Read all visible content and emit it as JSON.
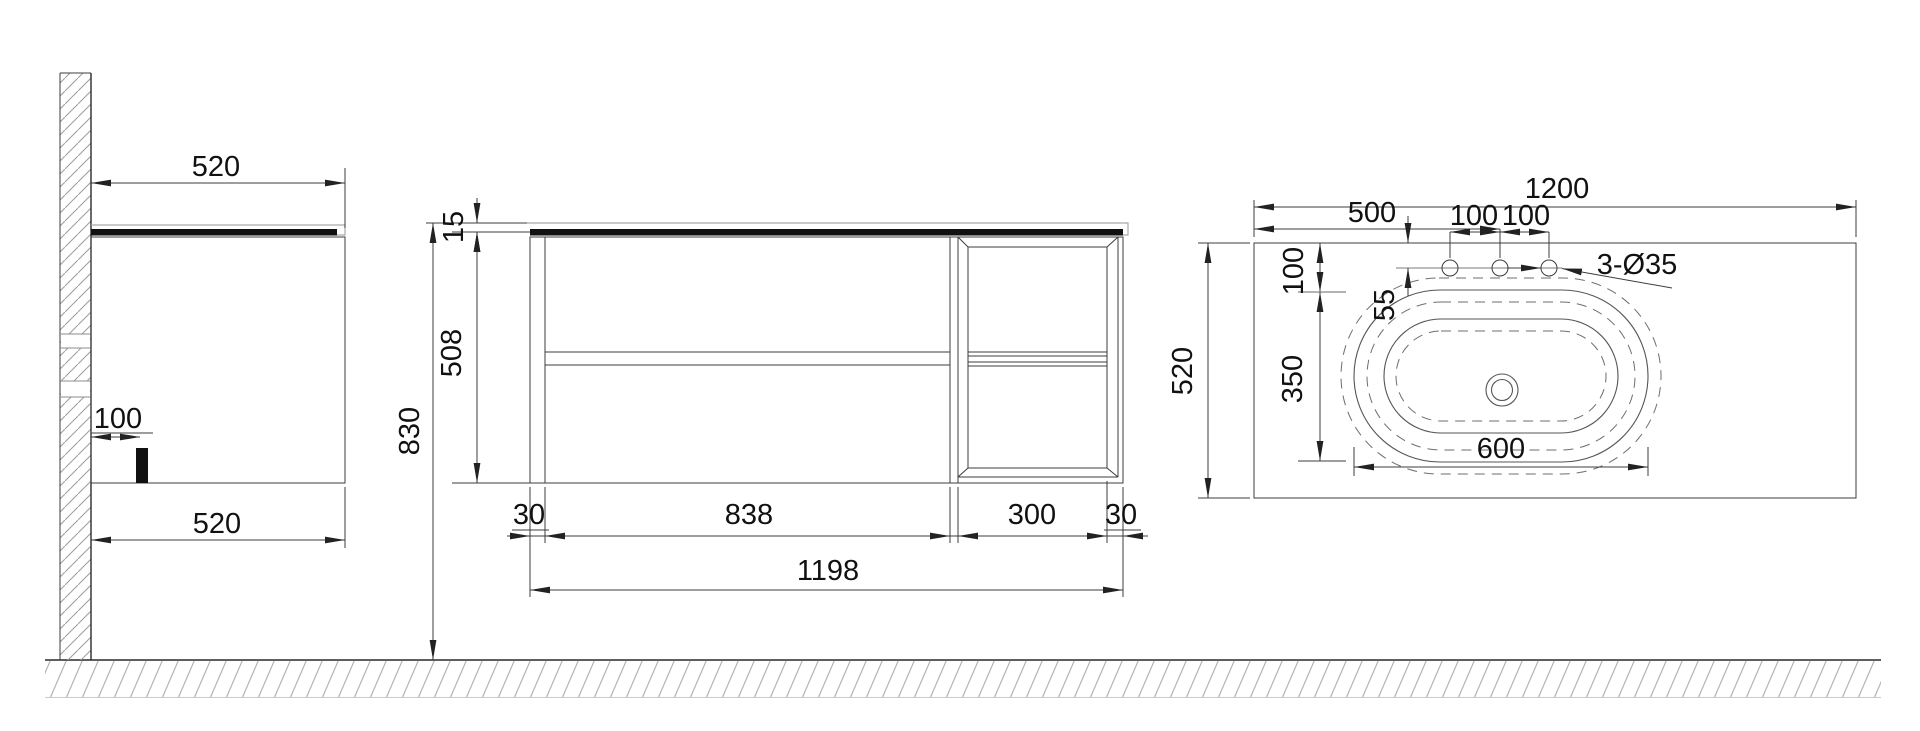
{
  "drawing": {
    "kind": "vanity cabinet technical drawing",
    "colors": {
      "line": "#2a2a2a",
      "hatch": "#9c9c9c",
      "slab": "#111111"
    },
    "views": {
      "side": {
        "dims": {
          "top_width": "520",
          "cleat_offset": "100",
          "bottom_width": "520"
        }
      },
      "front": {
        "dims": {
          "counter_thickness": "15",
          "cabinet_height": "508",
          "overall_height": "830",
          "left_gable": "30",
          "drawer_bay_width": "838",
          "shelf_bay_width": "300",
          "right_gable": "30",
          "cabinet_width": "1198"
        }
      },
      "top": {
        "dims": {
          "counter_width": "1200",
          "faucet_center_from_left": "500",
          "faucet_pitch_left": "100",
          "faucet_pitch_right": "100",
          "faucet_from_back": "55",
          "faucet_holes_note": "3-Ø35",
          "basin_from_back": "100",
          "basin_depth": "350",
          "counter_depth": "520",
          "basin_width": "600"
        }
      }
    }
  }
}
